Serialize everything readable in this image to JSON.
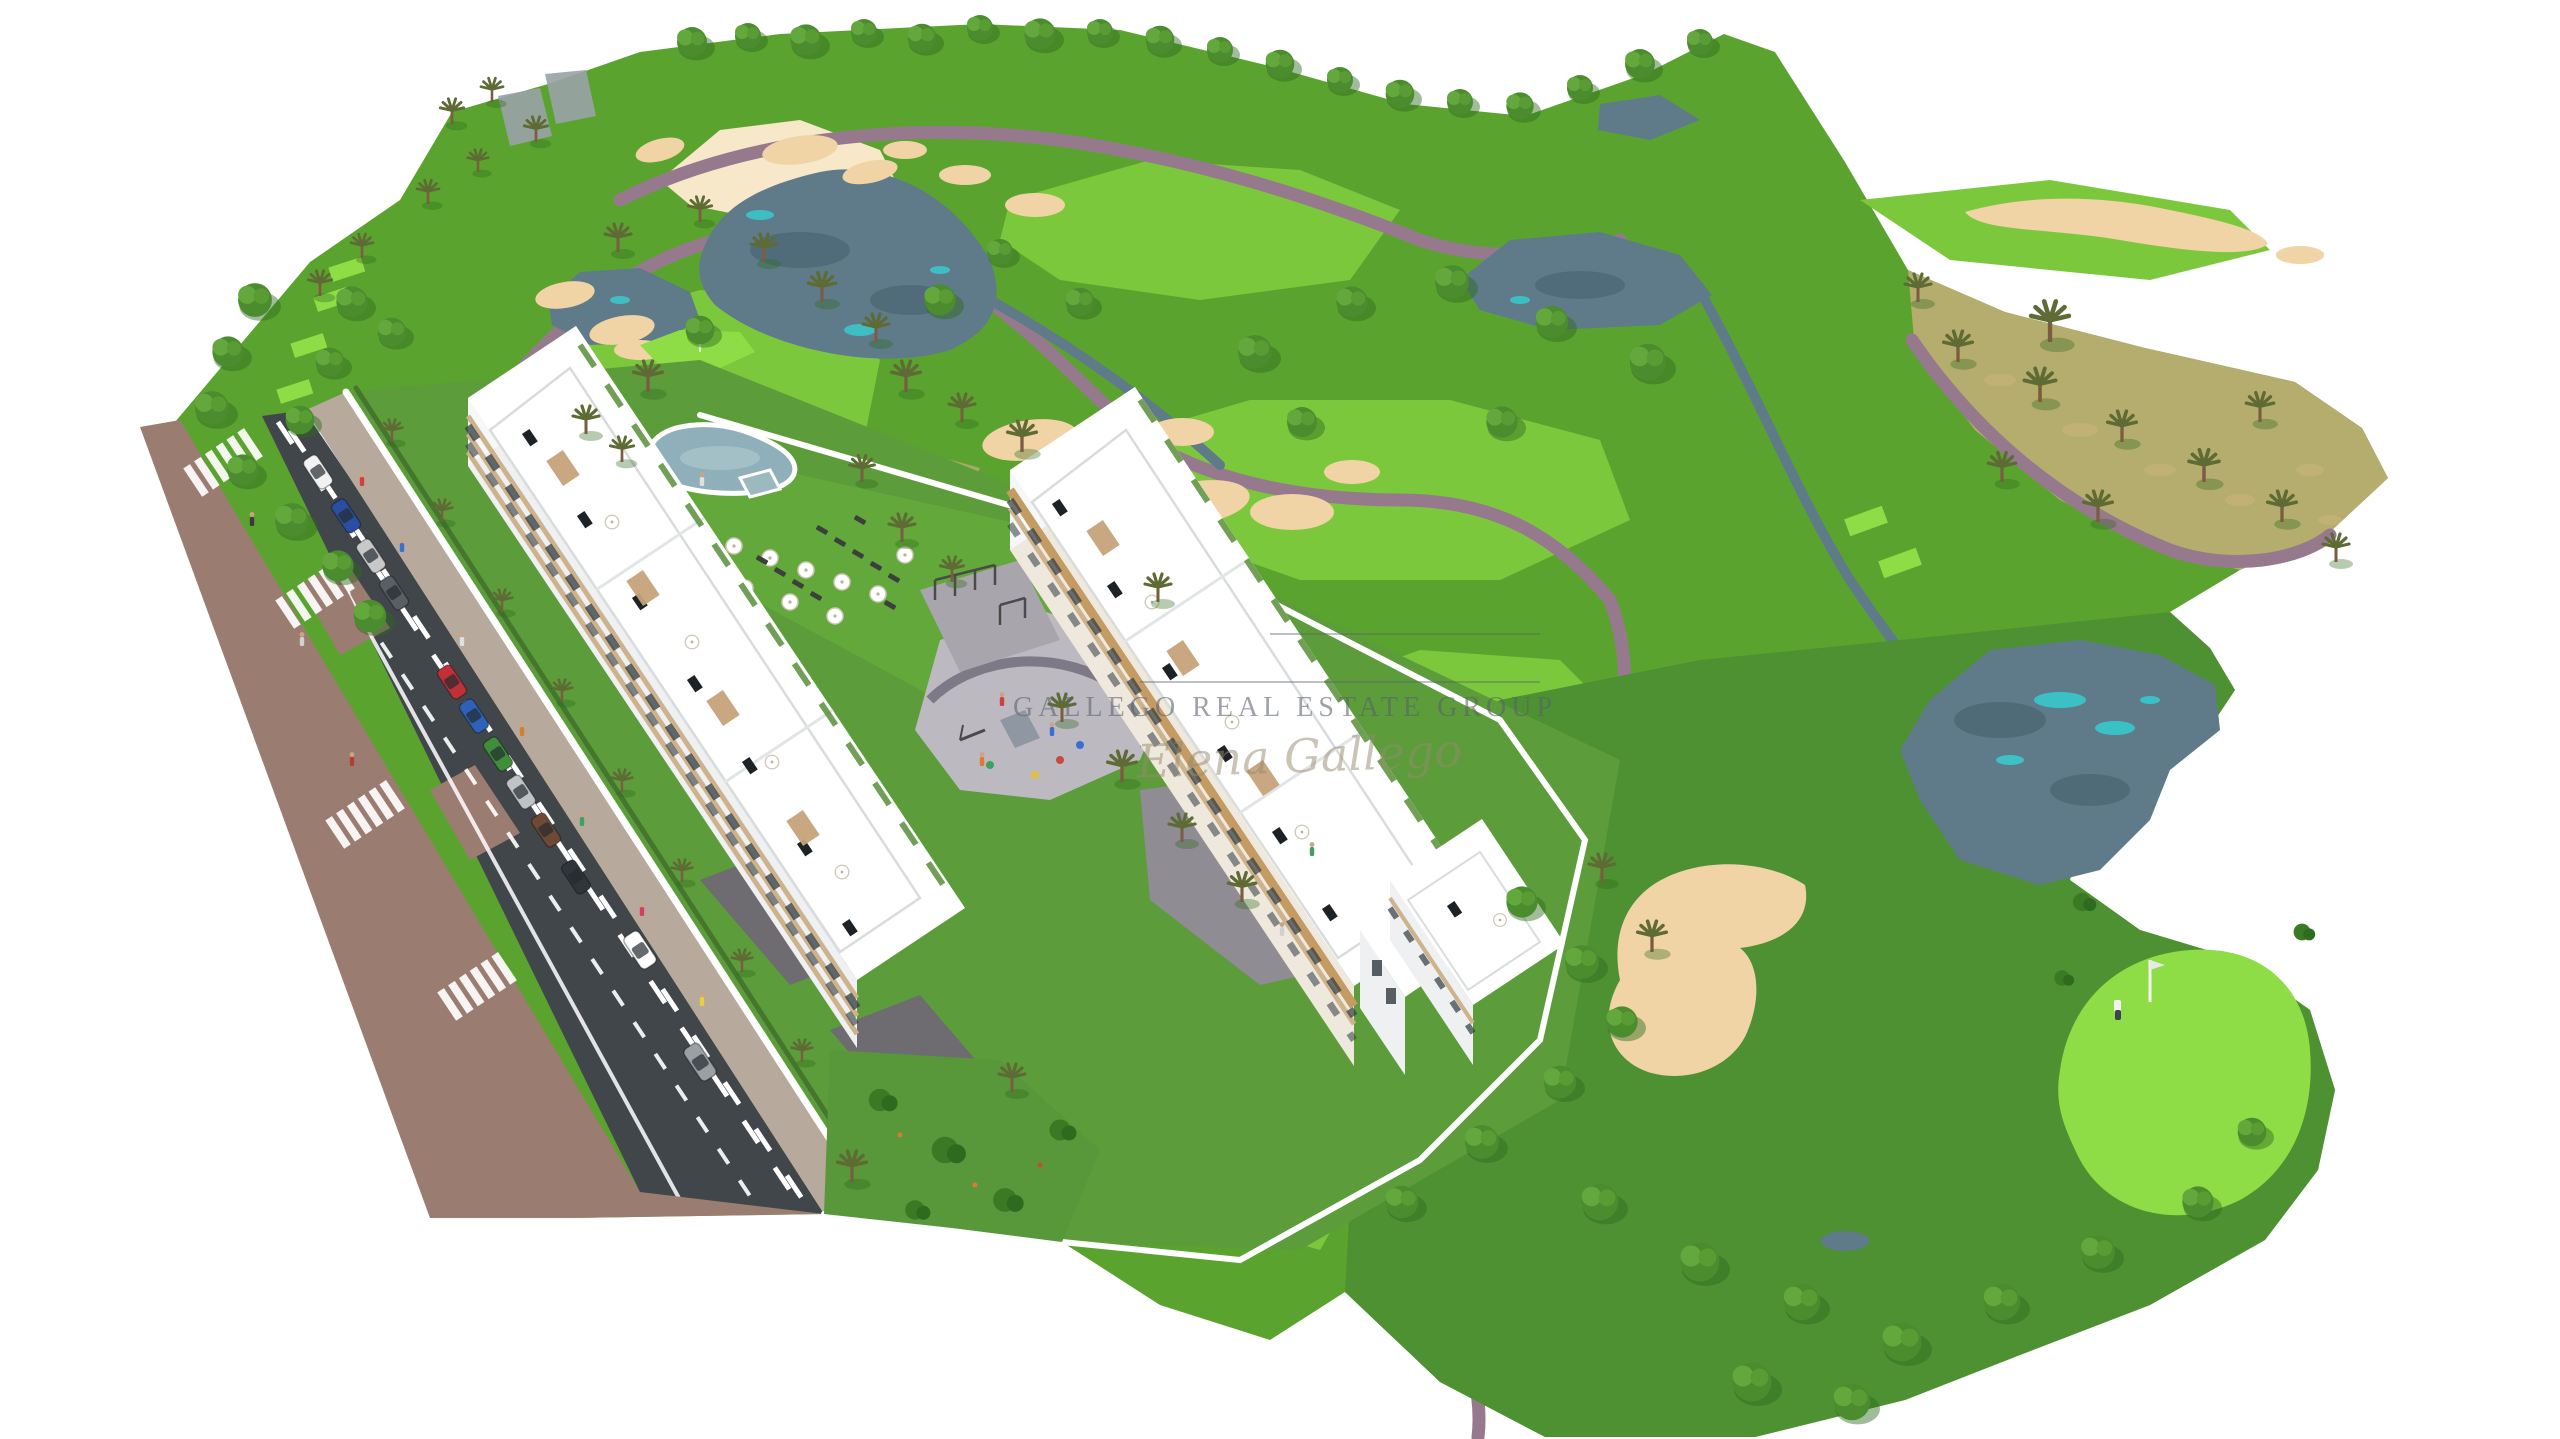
{
  "meta": {
    "type": "aerial-architectural-render",
    "subject": "3D bird's-eye render of a white apartment residential complex beside a golf course",
    "background": "#ffffff"
  },
  "watermark": {
    "brand": "GALLEGO REAL ESTATE GROUP",
    "signature": "Elena Gallego"
  },
  "colors": {
    "bg": "#ffffff",
    "rough": "#5ba32f",
    "roughDark": "#4e9132",
    "fairway": "#7cc83c",
    "bright": "#8edc46",
    "scrub": "#b5ad6e",
    "scrubDot": "#c8b478",
    "sand": "#f0d4a6",
    "sandPale": "#f7e8c9",
    "water": "#5f7b89",
    "waterDark": "#44606d",
    "teal": "#38c9cc",
    "pool": "#8fb0ba",
    "asphalt": "#41464b",
    "roadMark": "#ffffff",
    "brick": "#9b7c71",
    "paver": "#b7a99c",
    "plaza": "#bdb9c1",
    "plazaBand": "#7d7987",
    "driveway": "#6e6c71",
    "padel": "#cde2a2",
    "padelFence": "#41503c",
    "building": "#ffffff",
    "buildingShade": "#eef0f1",
    "buildingEnd": "#f6f7f7",
    "stoneFacade": "#efe9dd",
    "beigeBand": "#cdb28c",
    "stoneBand": "#c39b63",
    "windowSlot": "#2f3a40",
    "structure": "#9aa2a7",
    "cartPath": "#97798d",
    "wall": "#ffffff",
    "hedge": "#3e6e2a",
    "treeGreen": "#4a8c2e",
    "treeDark": "#2f6b1e",
    "treeLight": "#79bb4b",
    "palmGreen": "#5e6b34",
    "trunk": "#7b5c41",
    "lounger": "#3c403c",
    "pergola": "#c7a37a",
    "wmText": "#5a616c",
    "wmScript": "#95896f"
  },
  "scene": {
    "golf_course": {
      "label": "golf course",
      "features": [
        "fairways",
        "sand bunkers",
        "lakes with turquoise shallows",
        "winding cart paths",
        "putting green with flagstick and golfer",
        "palm trees and round trees",
        "dry scrub slope with palms",
        "golf cart on path"
      ]
    },
    "development": {
      "label": "residential complex",
      "features": [
        "two rows of white apartment blocks with stepped rooftop terraces",
        "lagoon-style communal pool",
        "sun loungers and white parasols",
        "playground and outdoor gym plaza",
        "padel court with green fence",
        "landscaped gardens",
        "white perimeter walls"
      ]
    },
    "street": {
      "label": "avenue",
      "features": [
        "asphalt road with dashed lane markings",
        "pedestrian crossings",
        "parked cars",
        "brick sidewalk",
        "pedestrians"
      ]
    }
  }
}
